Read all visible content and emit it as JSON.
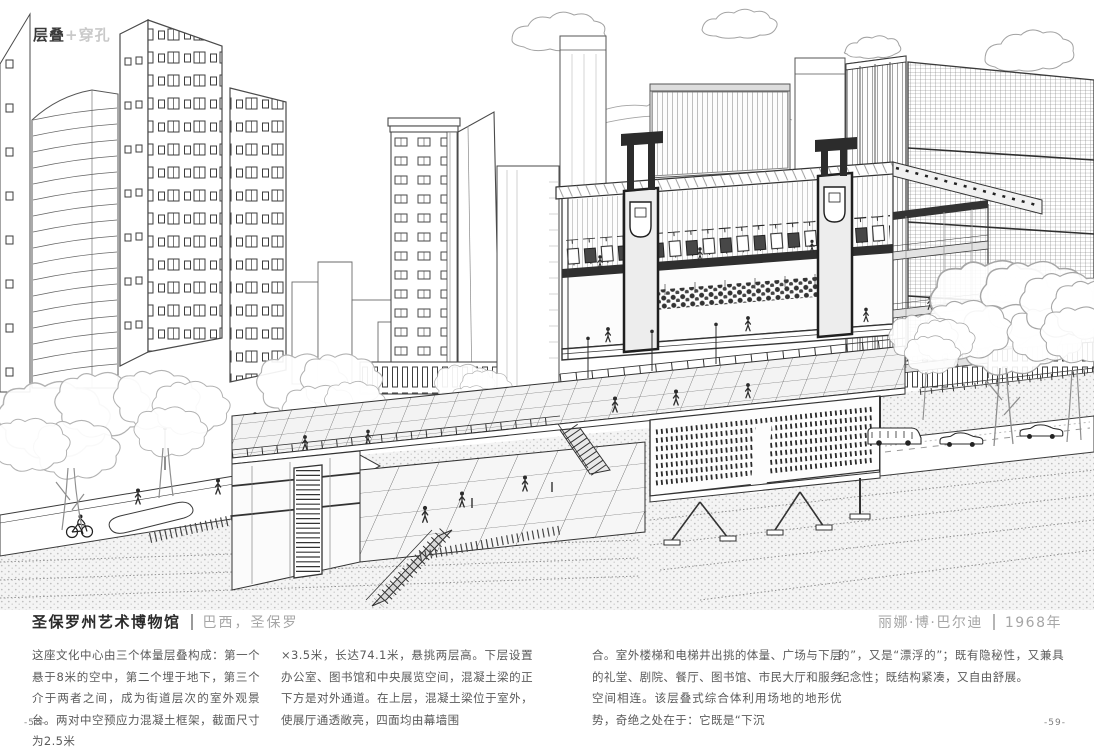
{
  "tag": {
    "primary": "层叠",
    "secondary": "+穿孔"
  },
  "article": {
    "title": "圣保罗州艺术博物馆",
    "location": "巴西，圣保罗",
    "architect": "丽娜·博·巴尔迪",
    "year": "1968年"
  },
  "body_columns": [
    "这座文化中心由三个体量层叠构成：第一个悬于8米的空中，第二个埋于地下，第三个介于两者之间，成为街道层次的室外观景台。两对中空预应力混凝土框架，截面尺寸为2.5米",
    "×3.5米，长达74.1米，悬挑两层高。下层设置办公室、图书馆和中央展览空间，混凝土梁的正下方是对外通道。在上层，混凝土梁位于室外，使展厅通透敞亮，四面均由幕墙围",
    "合。室外楼梯和电梯井出挑的体量、广场与下层的礼堂、剧院、餐厅、图书馆、市民大厅和服务空间相连。该层叠式综合体利用场地的地形优势，奇绝之处在于：它既是“下沉",
    "的”，又是“漂浮的”；既有隐秘性，又兼具纪念性；既结构紧凑，又自由舒展。"
  ],
  "footer": {
    "page_left": "-58-",
    "page_right": "-59-"
  }
}
